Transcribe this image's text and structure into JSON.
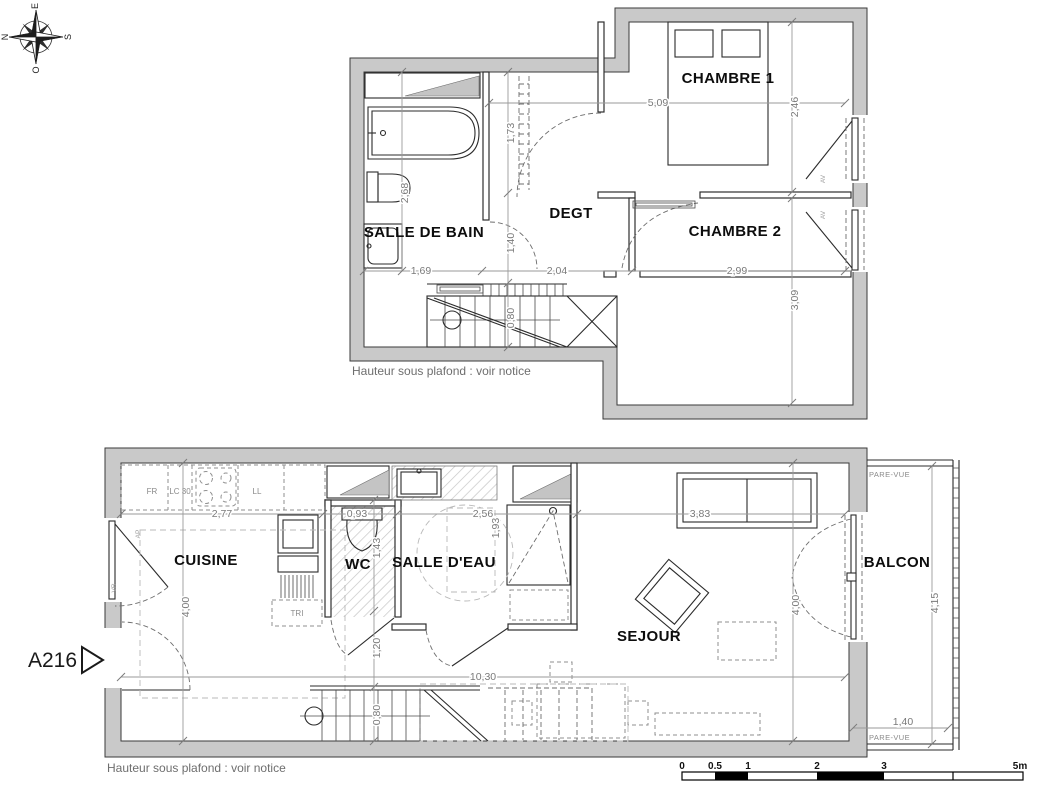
{
  "compass": {
    "e": "E",
    "n": "N",
    "s": "S",
    "o": "O"
  },
  "unit": {
    "label": "A216"
  },
  "upper_floor": {
    "rooms": {
      "chambre1": "CHAMBRE 1",
      "chambre2": "CHAMBRE 2",
      "salle_de_bain": "SALLE DE BAIN",
      "degt": "DEGT"
    },
    "dims": {
      "chambre1_width": "5,09",
      "chambre1_depth": "2,46",
      "closet_depth": "1,73",
      "sdb_length": "2,68",
      "degt_depth": "1,40",
      "sdb_width": "1,69",
      "degt_width": "2,04",
      "chambre2_width": "2,99",
      "chambre2_depth": "3,09",
      "stair_width": "0,80"
    },
    "window_labels": {
      "w1": "AV",
      "w2": "AV"
    },
    "note": "Hauteur sous plafond : voir notice"
  },
  "lower_floor": {
    "rooms": {
      "cuisine": "CUISINE",
      "wc": "WC",
      "salle_deau": "SALLE D'EAU",
      "sejour": "SEJOUR",
      "balcon": "BALCON"
    },
    "appliances": {
      "fr": "FR",
      "lc": "LC 30",
      "ll": "LL",
      "tri": "TRI"
    },
    "dims": {
      "kitchen_run": "2,77",
      "kitchen_depth": "4,00",
      "wc_width": "0,93",
      "wc_depth": "1,43",
      "sde_width": "2,56",
      "sde_depth": "1,93",
      "sofa_width": "3,83",
      "sejour_depth": "4,00",
      "total_width": "10,30",
      "stair_run": "1,20",
      "stair_width": "0,80",
      "balcon_depth": "4,15",
      "balcon_width": "1,40"
    },
    "window_labels": {
      "kitchen_top": "AP",
      "kitchen_bottom": "VR"
    },
    "pare_vue_top": "PARE-VUE",
    "pare_vue_bottom": "PARE-VUE",
    "note": "Hauteur sous plafond : voir notice"
  },
  "scale_bar": {
    "t0": "0",
    "t05": "0.5",
    "t1": "1",
    "t2": "2",
    "t3": "3",
    "t5": "5m"
  }
}
